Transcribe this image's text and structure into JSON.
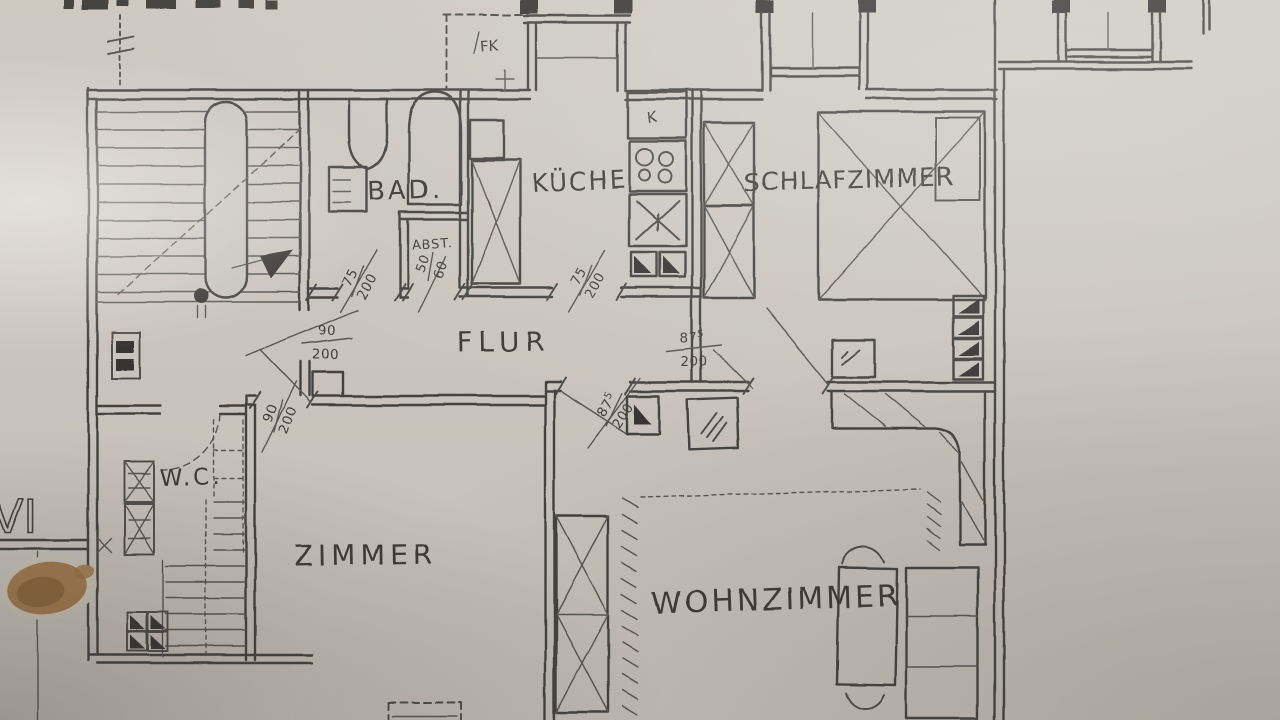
{
  "meta": {
    "drawing_type": "hand-drawn apartment floor plan, scanned photocopy",
    "paper_color": "#d7d3cc",
    "ink_color": "#3a3a38",
    "stain_color": "#a8763f"
  },
  "rooms": [
    {
      "id": "bad",
      "label": "BAD."
    },
    {
      "id": "abstellraum",
      "label": "ABST."
    },
    {
      "id": "kueche",
      "label": "KÜCHE"
    },
    {
      "id": "schlafzimmer",
      "label": "SCHLAFZIMMER"
    },
    {
      "id": "flur",
      "label": "FLUR"
    },
    {
      "id": "wc",
      "label": "W.C."
    },
    {
      "id": "zimmer",
      "label": "ZIMMER"
    },
    {
      "id": "wohnzimmer",
      "label": "WOHNZIMMER"
    }
  ],
  "annotations": [
    {
      "id": "fk",
      "label": "FK"
    },
    {
      "id": "fridge",
      "label": "K"
    },
    {
      "id": "sheet-numeral",
      "label": "VI"
    }
  ],
  "dimensions": [
    {
      "id": "door-bad",
      "num": "75",
      "den": "200"
    },
    {
      "id": "door-abst",
      "num": "50",
      "den": "60"
    },
    {
      "id": "door-flur-landing",
      "num": "90",
      "den": "200"
    },
    {
      "id": "door-kueche",
      "num": "75",
      "den": "200"
    },
    {
      "id": "door-schlafzimmer",
      "num": "87",
      "sup": "5",
      "den": "200"
    },
    {
      "id": "door-wohnzimmer",
      "num": "87",
      "sup": "5",
      "den": "200"
    },
    {
      "id": "door-zimmer",
      "num": "90",
      "den": "200"
    }
  ]
}
